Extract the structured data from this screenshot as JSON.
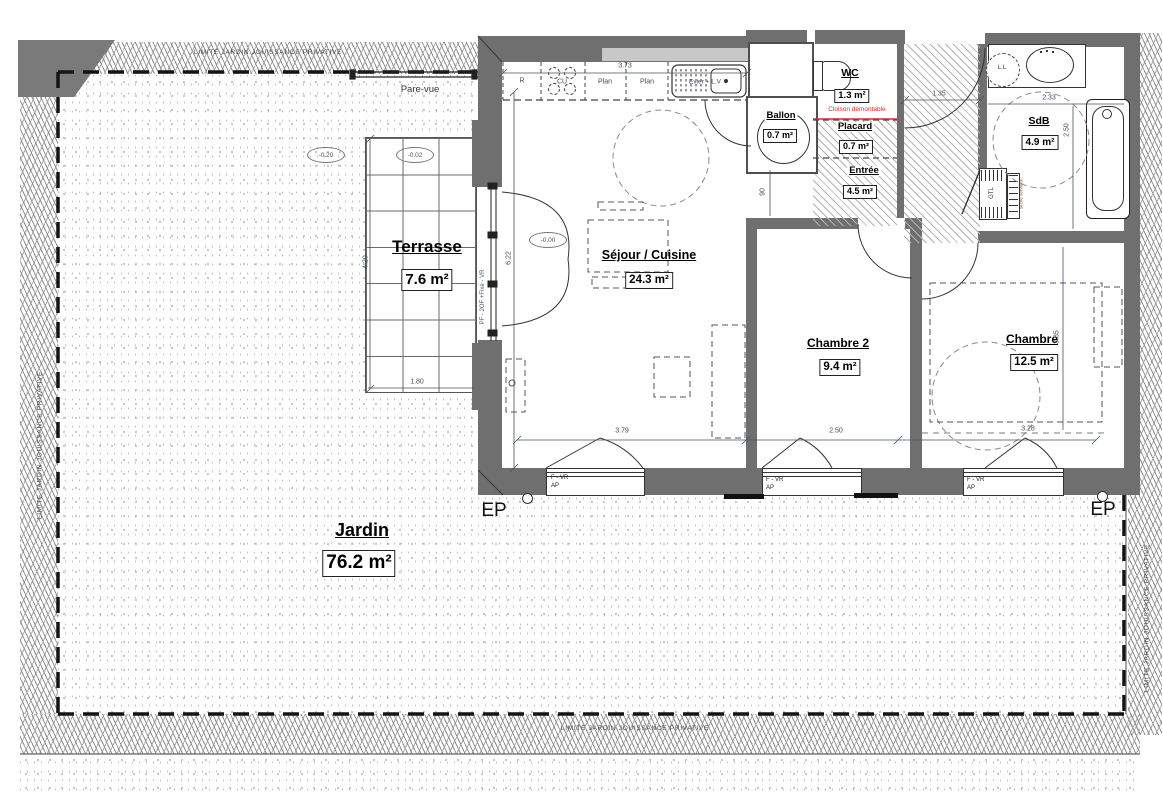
{
  "plan": {
    "limite_label": "LIMITE JARDIN JOUISSANCE PRIVATIVE",
    "pare_vue_label": "Pare-vue",
    "ep_label": "EP",
    "bay_window_label": "PF - 2OF +Fixe - VR",
    "cloison_label": "Cloison démontable",
    "window_label_line1": "F - VR",
    "window_label_line2": "AP"
  },
  "rooms": {
    "jardin": {
      "name": "Jardin",
      "area": "76.2 m²"
    },
    "terrasse": {
      "name": "Terrasse",
      "area": "7.6 m²"
    },
    "sejour": {
      "name": "Séjour / Cuisine",
      "area": "24.3 m²"
    },
    "chambre2": {
      "name": "Chambre 2",
      "area": "9.4 m²"
    },
    "chambre": {
      "name": "Chambre",
      "area": "12.5 m²"
    },
    "sdb": {
      "name": "SdB",
      "area": "4.9 m²"
    },
    "wc": {
      "name": "WC",
      "area": "1.3 m²"
    },
    "ballon": {
      "name": "Ballon",
      "area": "0.7 m²"
    },
    "placard": {
      "name": "Placard",
      "area": "0.7 m²"
    },
    "entree": {
      "name": "Entrée",
      "area": "4.5 m²"
    }
  },
  "kitchen": {
    "fridge": "R",
    "hob": "CU",
    "counter1": "Plan",
    "counter2": "Plan",
    "sink": "Evier + L.V"
  },
  "fixtures": {
    "washing_machine": "L.L",
    "gtl": "GTL",
    "towel_rail": "sèche serviette"
  },
  "levels": {
    "jardin": "-0.20",
    "terrasse": "-0.02",
    "interior": "-0.00"
  },
  "dimensions": {
    "kitchen_width": "3.73",
    "sejour_width": "3.79",
    "chambre2_width": "2.50",
    "chambre_width": "3.28",
    "sejour_height": "6.22",
    "terrasse_height": "4.20",
    "terrasse_width": "1.80",
    "sdb_width": "2.33",
    "sdb_height": "2.50",
    "chambre_height": "3.85",
    "entree_width": "1.35",
    "door_width": "90"
  },
  "colors": {
    "wall": "#6f6f6f",
    "wall_light": "#c8c8c8",
    "accent_red": "#d92b26"
  }
}
